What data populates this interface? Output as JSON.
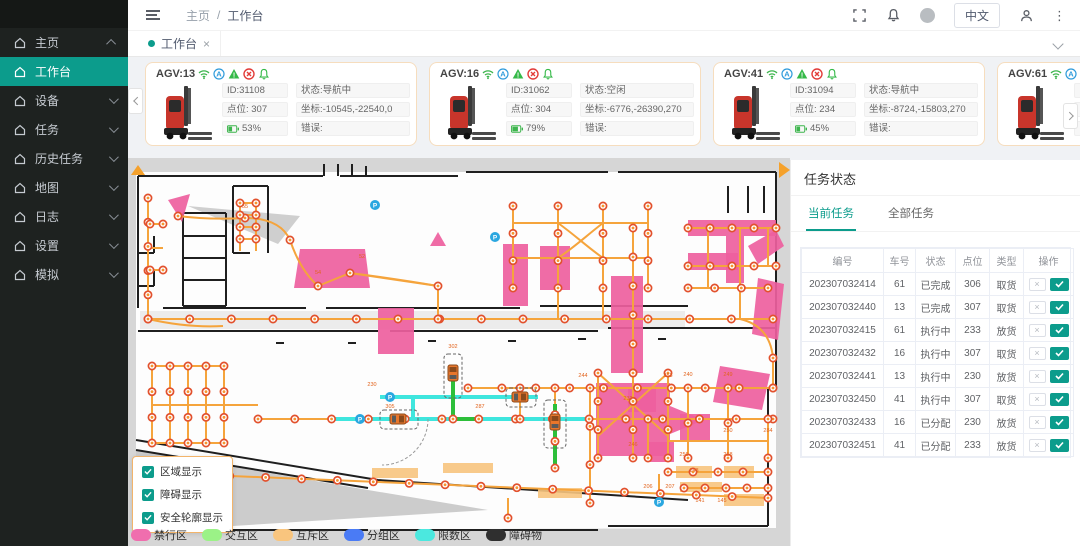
{
  "accent": "#0c9c8c",
  "header": {
    "breadcrumb": [
      "主页",
      "工作台"
    ],
    "language_button": "中文",
    "icons": [
      "fullscreen-icon",
      "bell-icon",
      "avatar",
      "person-icon",
      "more-dots-icon"
    ]
  },
  "sidebar": {
    "active_index": 1,
    "items": [
      {
        "label": "主页",
        "arrow": "up"
      },
      {
        "label": "工作台",
        "arrow": ""
      },
      {
        "label": "设备",
        "arrow": "down"
      },
      {
        "label": "任务",
        "arrow": "down"
      },
      {
        "label": "历史任务",
        "arrow": "down"
      },
      {
        "label": "地图",
        "arrow": "down"
      },
      {
        "label": "日志",
        "arrow": "down"
      },
      {
        "label": "设置",
        "arrow": "down"
      },
      {
        "label": "模拟",
        "arrow": "down"
      }
    ]
  },
  "tabbar": {
    "tabs": [
      {
        "label": "工作台"
      }
    ]
  },
  "card_icon_names": [
    "wifi-icon",
    "auto-mode-icon",
    "warning-triangle-icon",
    "error-circle-icon",
    "alarm-bell-icon"
  ],
  "agv_cards": [
    {
      "name": "AGV:13",
      "id": "ID:31108",
      "status": "状态:导航中",
      "point": "点位: 307",
      "coord": "坐标:-10545,-22540,0",
      "battery": "53%",
      "battery_pct": 53,
      "error": "错误:"
    },
    {
      "name": "AGV:16",
      "id": "ID:31062",
      "status": "状态:空闲",
      "point": "点位: 304",
      "coord": "坐标:-6776,-26390,270",
      "battery": "79%",
      "battery_pct": 79,
      "error": "错误:"
    },
    {
      "name": "AGV:41",
      "id": "ID:31094",
      "status": "状态:导航中",
      "point": "点位: 234",
      "coord": "坐标:-8724,-15803,270",
      "battery": "45%",
      "battery_pct": 45,
      "error": "错误:"
    },
    {
      "name": "AGV:61",
      "id": "",
      "status": "",
      "point": "",
      "coord": "",
      "battery": "",
      "battery_pct": 0,
      "error": ""
    }
  ],
  "task_panel": {
    "title": "任务状态",
    "tabs": [
      "当前任务",
      "全部任务"
    ],
    "active_tab": 0,
    "table": {
      "headers": [
        "编号",
        "车号",
        "状态",
        "点位",
        "类型",
        "操作"
      ],
      "rows": [
        {
          "no": "202307032414",
          "car": "61",
          "status": "已完成",
          "point": "306",
          "type": "取货"
        },
        {
          "no": "202307032440",
          "car": "13",
          "status": "已完成",
          "point": "307",
          "type": "取货"
        },
        {
          "no": "202307032415",
          "car": "61",
          "status": "执行中",
          "point": "233",
          "type": "放货"
        },
        {
          "no": "202307032432",
          "car": "16",
          "status": "执行中",
          "point": "307",
          "type": "取货"
        },
        {
          "no": "202307032441",
          "car": "13",
          "status": "执行中",
          "point": "230",
          "type": "放货"
        },
        {
          "no": "202307032450",
          "car": "41",
          "status": "执行中",
          "point": "307",
          "type": "取货"
        },
        {
          "no": "202307032433",
          "car": "16",
          "status": "已分配",
          "point": "230",
          "type": "放货"
        },
        {
          "no": "202307032451",
          "car": "41",
          "status": "已分配",
          "point": "233",
          "type": "放货"
        }
      ]
    }
  },
  "map": {
    "overlay_checkboxes": [
      {
        "label": "区域显示",
        "checked": true
      },
      {
        "label": "障碍显示",
        "checked": true
      },
      {
        "label": "安全轮廓显示",
        "checked": true
      }
    ],
    "legend": [
      {
        "label": "禁行区",
        "color": "#f06eae"
      },
      {
        "label": "交互区",
        "color": "#9bf287"
      },
      {
        "label": "互斥区",
        "color": "#f9c57e"
      },
      {
        "label": "分组区",
        "color": "#4a7bf5"
      },
      {
        "label": "限数区",
        "color": "#4be8df"
      },
      {
        "label": "障碍物",
        "color": "#2f2f2f"
      }
    ],
    "node_labels": [
      {
        "t": "230",
        "x": 244,
        "y": 234
      },
      {
        "t": "305",
        "x": 262,
        "y": 256
      },
      {
        "t": "302",
        "x": 325,
        "y": 196
      },
      {
        "t": "287",
        "x": 352,
        "y": 256
      },
      {
        "t": "244",
        "x": 455,
        "y": 225
      },
      {
        "t": "253",
        "x": 540,
        "y": 225
      },
      {
        "t": "232",
        "x": 500,
        "y": 248
      },
      {
        "t": "240",
        "x": 560,
        "y": 224
      },
      {
        "t": "249",
        "x": 600,
        "y": 224
      },
      {
        "t": "246",
        "x": 505,
        "y": 294
      },
      {
        "t": "250",
        "x": 600,
        "y": 280
      },
      {
        "t": "284",
        "x": 640,
        "y": 280
      },
      {
        "t": "256",
        "x": 556,
        "y": 304
      },
      {
        "t": "258",
        "x": 600,
        "y": 304
      },
      {
        "t": "148",
        "x": 566,
        "y": 320
      },
      {
        "t": "206",
        "x": 520,
        "y": 336
      },
      {
        "t": "207",
        "x": 542,
        "y": 336
      },
      {
        "t": "141",
        "x": 572,
        "y": 350
      },
      {
        "t": "145",
        "x": 594,
        "y": 350
      },
      {
        "t": "55",
        "x": 117,
        "y": 56
      },
      {
        "t": "54",
        "x": 190,
        "y": 122
      },
      {
        "t": "52",
        "x": 234,
        "y": 106
      }
    ]
  }
}
